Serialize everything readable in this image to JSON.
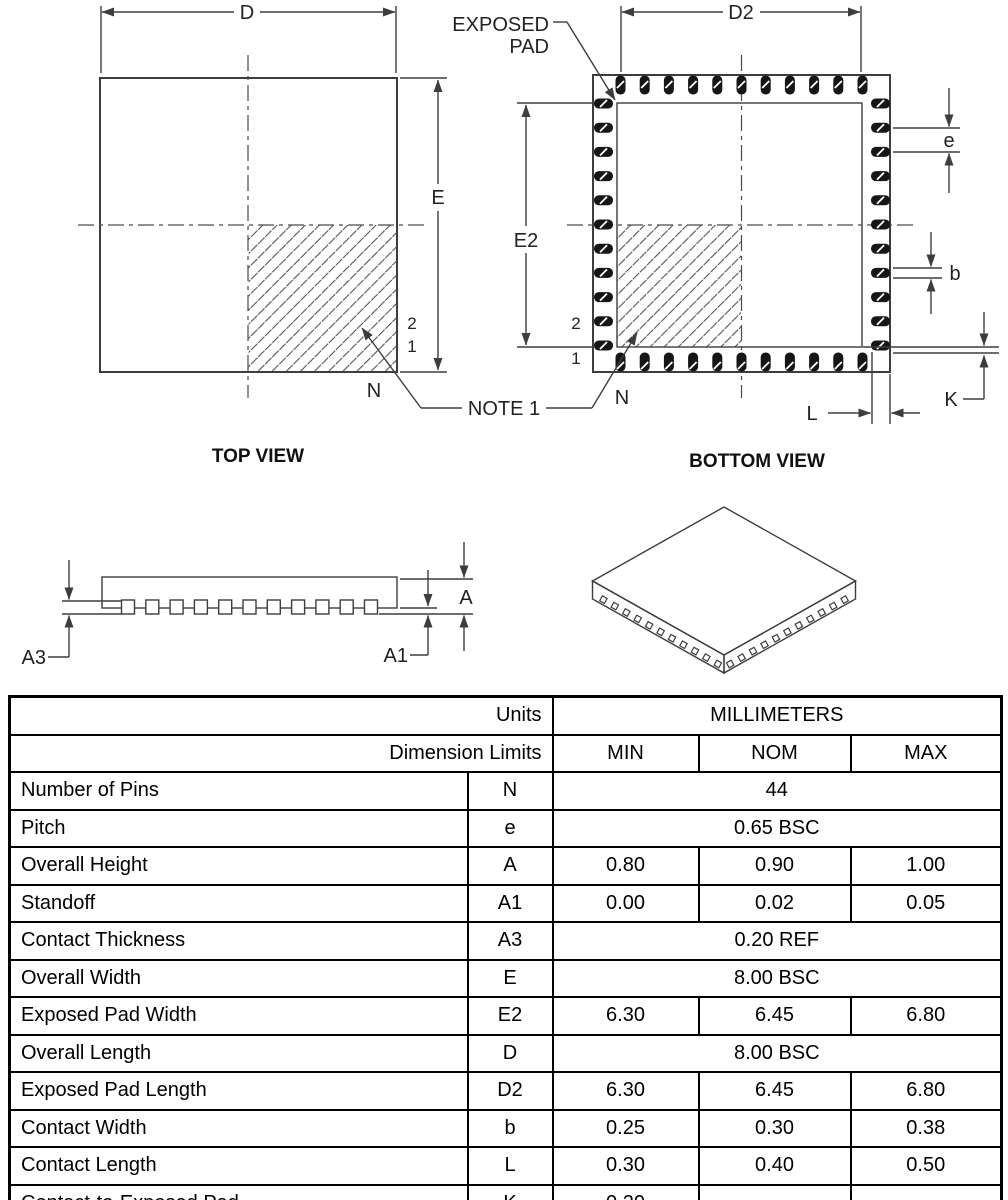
{
  "colors": {
    "line": "#3d3d3d",
    "pin": "#161616",
    "text": "#222222",
    "table_border": "#000000"
  },
  "views": {
    "top": {
      "title": "TOP VIEW",
      "dim_d": "D",
      "dim_e": "E",
      "pin2": "2",
      "pin1": "1",
      "pin_n": "N"
    },
    "bottom": {
      "title": "BOTTOM VIEW",
      "dim_d2": "D2",
      "dim_e2": "E2",
      "dim_e": "e",
      "dim_b": "b",
      "dim_k": "K",
      "dim_l": "L",
      "pin2": "2",
      "pin1": "1",
      "pin_n": "N",
      "exposed_pad_line1": "EXPOSED",
      "exposed_pad_line2": "PAD"
    },
    "side": {
      "dim_a": "A",
      "dim_a1": "A1",
      "dim_a3": "A3"
    },
    "note1": "NOTE 1"
  },
  "table": {
    "header": {
      "units_label": "Units",
      "units_value": "MILLIMETERS",
      "limits_label": "Dimension Limits",
      "min": "MIN",
      "nom": "NOM",
      "max": "MAX"
    },
    "rows": [
      {
        "name": "Number of Pins",
        "symbol": "N",
        "span": "44"
      },
      {
        "name": "Pitch",
        "symbol": "e",
        "span": "0.65 BSC"
      },
      {
        "name": "Overall Height",
        "symbol": "A",
        "min": "0.80",
        "nom": "0.90",
        "max": "1.00"
      },
      {
        "name": "Standoff",
        "symbol": "A1",
        "min": "0.00",
        "nom": "0.02",
        "max": "0.05"
      },
      {
        "name": "Contact Thickness",
        "symbol": "A3",
        "span": "0.20 REF"
      },
      {
        "name": "Overall Width",
        "symbol": "E",
        "span": "8.00 BSC"
      },
      {
        "name": "Exposed Pad Width",
        "symbol": "E2",
        "min": "6.30",
        "nom": "6.45",
        "max": "6.80"
      },
      {
        "name": "Overall Length",
        "symbol": "D",
        "span": "8.00 BSC"
      },
      {
        "name": "Exposed Pad Length",
        "symbol": "D2",
        "min": "6.30",
        "nom": "6.45",
        "max": "6.80"
      },
      {
        "name": "Contact Width",
        "symbol": "b",
        "min": "0.25",
        "nom": "0.30",
        "max": "0.38"
      },
      {
        "name": "Contact Length",
        "symbol": "L",
        "min": "0.30",
        "nom": "0.40",
        "max": "0.50"
      },
      {
        "name": "Contact-to-Exposed Pad",
        "symbol": "K",
        "min": "0.20",
        "nom": "–",
        "max": "–"
      }
    ]
  }
}
